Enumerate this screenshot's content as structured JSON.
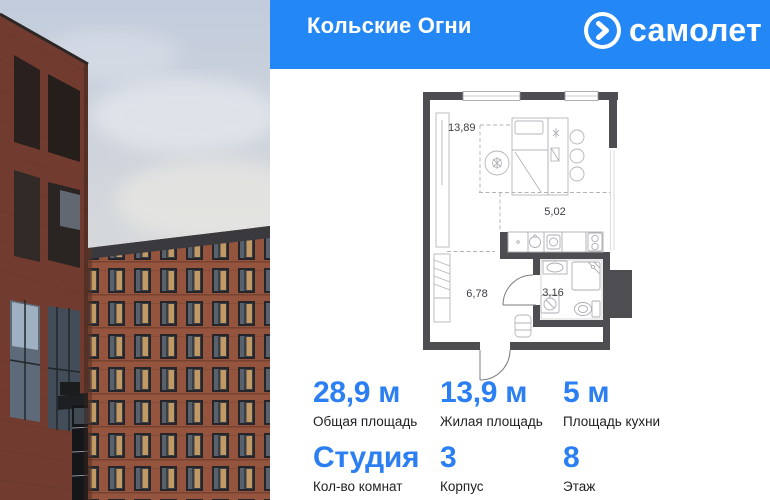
{
  "header": {
    "project_title": "Кольские Огни",
    "brand_name": "самолет",
    "brand_icon": "chevron-right-icon",
    "bg_color": "#2387F5"
  },
  "photo": {
    "description": "red-brick apartment buildings against cloudy sky"
  },
  "floorplan": {
    "rooms": [
      {
        "name": "living-room",
        "area": "13,89"
      },
      {
        "name": "kitchen",
        "area": "5,02"
      },
      {
        "name": "hallway",
        "area": "6,78"
      },
      {
        "name": "bathroom",
        "area": "3,16"
      }
    ],
    "wall_color": "#4E4E52"
  },
  "stats": {
    "items": [
      {
        "value": "28,9 м",
        "label": "Общая площадь"
      },
      {
        "value": "13,9 м",
        "label": "Жилая площадь"
      },
      {
        "value": "5 м",
        "label": "Площадь кухни"
      },
      {
        "value": "Студия",
        "label": "Кол-во комнат"
      },
      {
        "value": "3",
        "label": "Корпус"
      },
      {
        "value": "8",
        "label": "Этаж"
      }
    ],
    "value_color": "#2B7FF2"
  }
}
